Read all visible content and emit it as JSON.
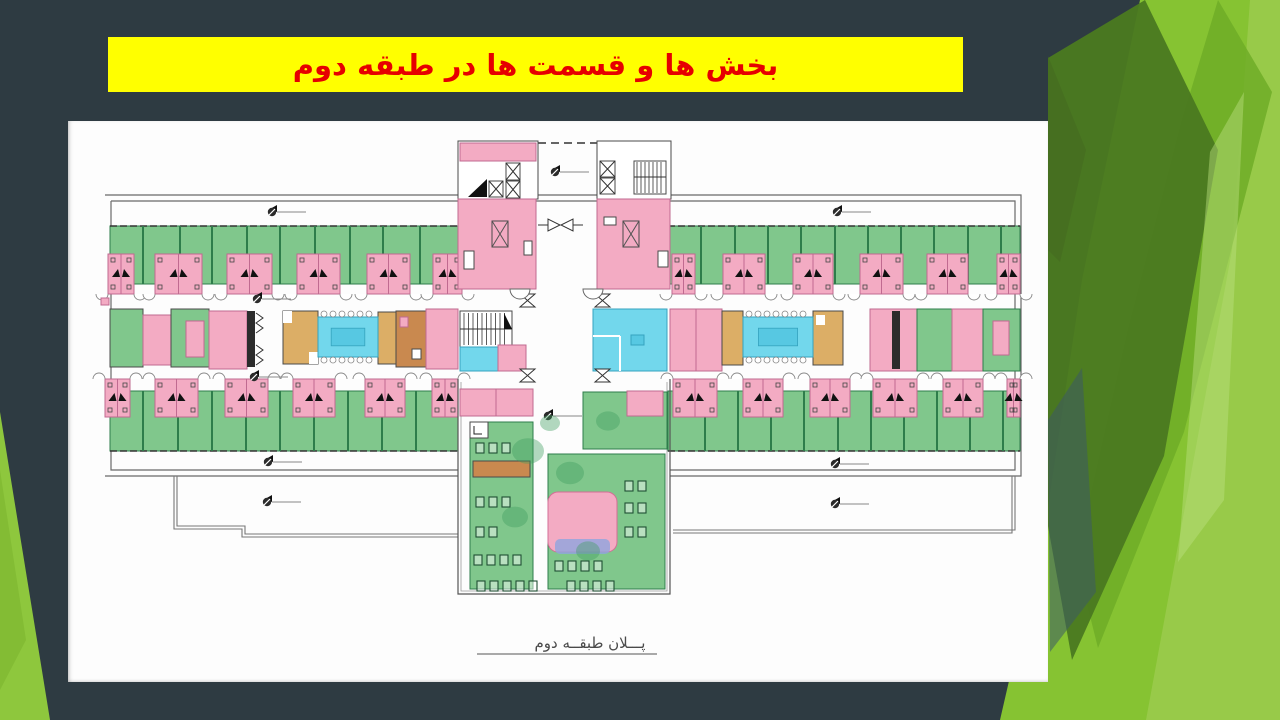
{
  "banner": {
    "text": "بخش ها و قسمت ها در طبقه دوم",
    "bg": "#FFFF00",
    "color": "#E60000"
  },
  "plan": {
    "caption": "پـــلان طبقــه دوم",
    "colors": {
      "green": "#80c78c",
      "green_dark": "#3f9e5f",
      "green_line": "#2e7d4b",
      "pink": "#f3abc3",
      "pink_line": "#c06a90",
      "cyan": "#72d7ec",
      "cyan_dark": "#57c8e2",
      "tan": "#dcae66",
      "orange": "#c9894f",
      "wall": "#4a4a4a",
      "blue_scribble": "#8fa5de"
    },
    "top_row": {
      "left_cells": [
        [
          40,
          26
        ],
        [
          87,
          47
        ],
        [
          159,
          45
        ],
        [
          229,
          43
        ],
        [
          299,
          43
        ],
        [
          365,
          29
        ]
      ],
      "right_cells": [
        [
          604,
          23
        ],
        [
          655,
          42
        ],
        [
          725,
          40
        ],
        [
          792,
          43
        ],
        [
          859,
          41
        ],
        [
          929,
          23
        ]
      ],
      "left_dividers": [
        75,
        112,
        144,
        179,
        212,
        247,
        282,
        315,
        352
      ],
      "right_dividers": [
        633,
        667,
        700,
        733,
        767,
        800,
        833,
        866,
        900,
        933
      ]
    },
    "bottom_row": {
      "left_cells": [
        [
          37,
          25
        ],
        [
          87,
          43
        ],
        [
          157,
          43
        ],
        [
          225,
          42
        ],
        [
          297,
          40
        ],
        [
          364,
          26
        ]
      ],
      "right_cells": [
        [
          605,
          44
        ],
        [
          675,
          40
        ],
        [
          742,
          40
        ],
        [
          805,
          44
        ],
        [
          875,
          40
        ],
        [
          939,
          13
        ]
      ],
      "left_dividers": [
        75,
        110,
        144,
        178,
        212,
        246,
        280,
        314,
        348
      ],
      "right_dividers": [
        637,
        670,
        703,
        736,
        770,
        803,
        836,
        869,
        902,
        935
      ]
    },
    "day_rooms": [
      [
        250,
        196,
        60,
        40
      ],
      [
        675,
        196,
        70,
        40
      ]
    ],
    "markers": [
      [
        204,
        91
      ],
      [
        769,
        91
      ],
      [
        189,
        178
      ],
      [
        186,
        256
      ],
      [
        480,
        295
      ],
      [
        200,
        341
      ],
      [
        199,
        381
      ],
      [
        767,
        343
      ],
      [
        767,
        383
      ],
      [
        487,
        51
      ]
    ],
    "seat_rows": [
      [
        408,
        322,
        3
      ],
      [
        408,
        376,
        3
      ],
      [
        408,
        406,
        2
      ],
      [
        406,
        434,
        4
      ],
      [
        409,
        460,
        5
      ],
      [
        487,
        440,
        4
      ],
      [
        499,
        460,
        4
      ],
      [
        557,
        360,
        2
      ],
      [
        557,
        382,
        2
      ],
      [
        557,
        406,
        2
      ]
    ],
    "trees": [
      [
        460,
        330,
        16
      ],
      [
        502,
        352,
        14
      ],
      [
        447,
        396,
        13
      ],
      [
        520,
        430,
        12
      ],
      [
        482,
        302,
        10
      ],
      [
        540,
        300,
        12
      ]
    ]
  },
  "decor": {
    "facets": [
      {
        "points": "1140,0 1280,0 1280,720 1000,720 1046,520 1082,280",
        "fill": "#86c332",
        "opacity": 1
      },
      {
        "points": "1250,0 1280,0 1280,720 1146,720 1232,250",
        "fill": "#9ACB4B",
        "opacity": 0.9
      },
      {
        "points": "1218,0 1272,92 1184,432 1098,648 1076,560 1128,330 1182,120",
        "fill": "#6FAD27",
        "opacity": 0.85
      },
      {
        "points": "1145,0 1218,150 1164,456 1072,660 1048,526 1048,58",
        "fill": "#4B7A20",
        "opacity": 0.96
      },
      {
        "points": "1210,152 1244,92 1224,500 1178,562",
        "fill": "#BCDF80",
        "opacity": 0.45
      },
      {
        "points": "1048,420 1082,368 1096,592 1050,652",
        "fill": "#3D5A66",
        "opacity": 0.55
      },
      {
        "points": "1048,56 1086,150 1060,262 1048,250",
        "fill": "#44671F",
        "opacity": 0.5
      }
    ],
    "wedge": [
      {
        "points": "0,412 50,720 0,720",
        "fill": "#8EC73D",
        "opacity": 1
      },
      {
        "points": "0,470 26,640 0,690",
        "fill": "#7AB22E",
        "opacity": 0.55
      }
    ]
  }
}
